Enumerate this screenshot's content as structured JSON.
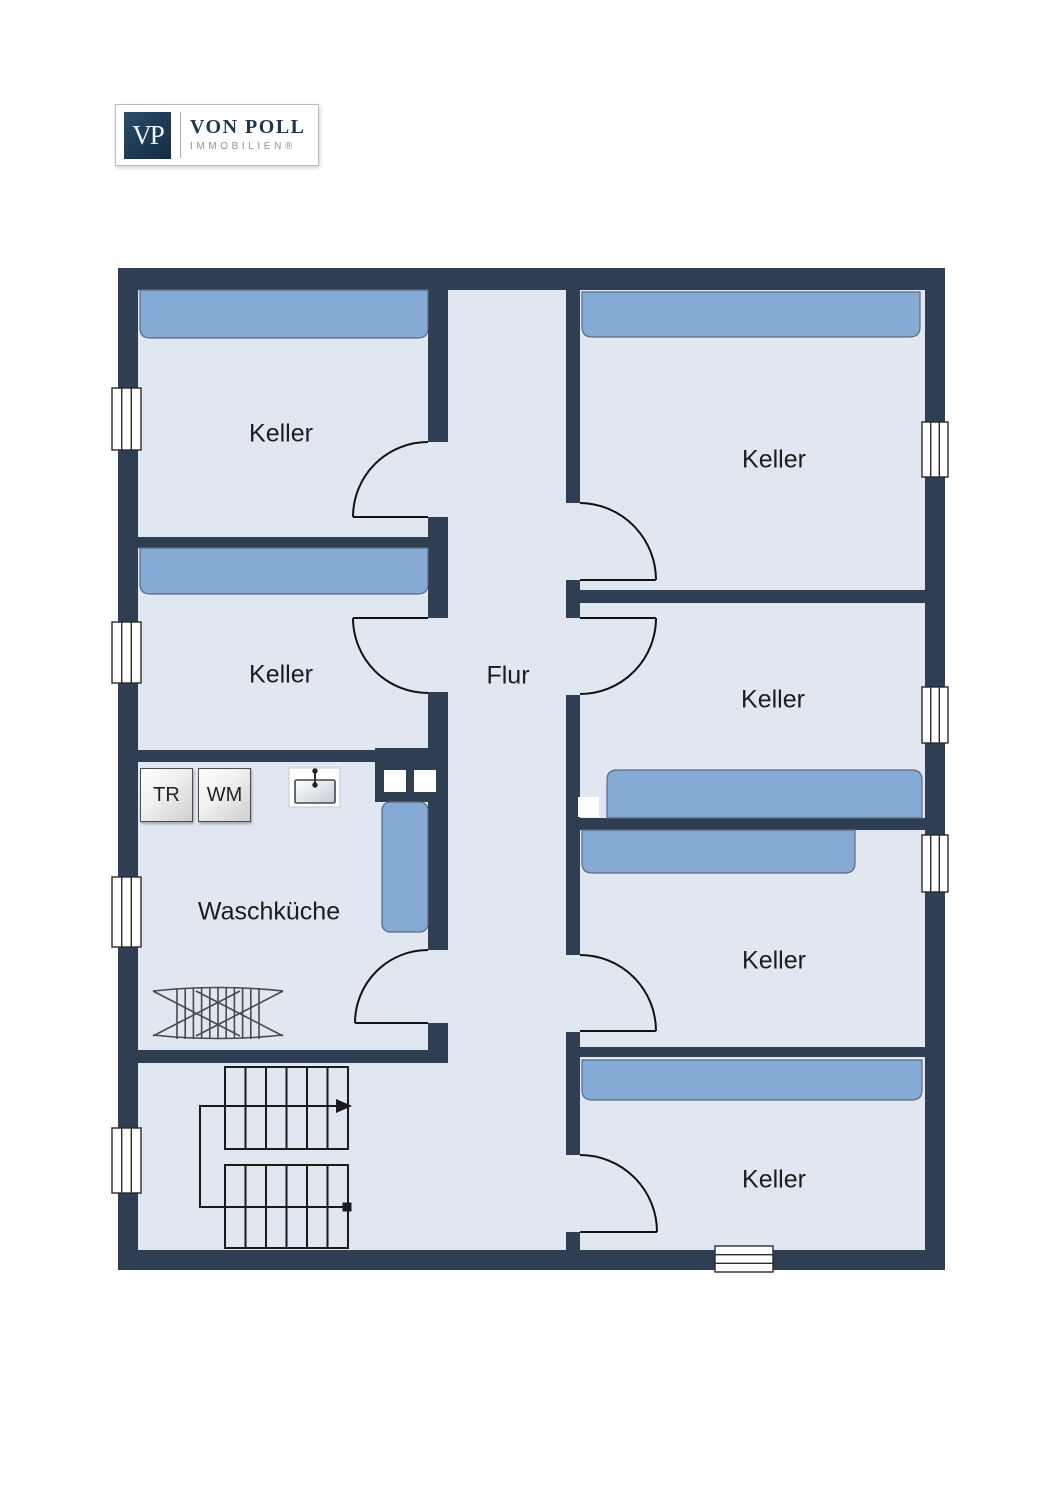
{
  "logo": {
    "monogram": "VP",
    "brand": "VON POLL",
    "division": "IMMOBILIEN®"
  },
  "plan": {
    "floor": "basement",
    "rooms": [
      {
        "id": "keller-top-left",
        "label": "Keller"
      },
      {
        "id": "keller-mid-left",
        "label": "Keller"
      },
      {
        "id": "waschkueche",
        "label": "Waschküche"
      },
      {
        "id": "flur",
        "label": "Flur"
      },
      {
        "id": "keller-top-right",
        "label": "Keller"
      },
      {
        "id": "keller-mid-right",
        "label": "Keller"
      },
      {
        "id": "keller-lower-right",
        "label": "Keller"
      },
      {
        "id": "keller-bottom-right",
        "label": "Keller"
      }
    ],
    "appliances": [
      {
        "id": "dryer",
        "label": "TR"
      },
      {
        "id": "washing-machine",
        "label": "WM"
      }
    ],
    "fixtures": [
      "sink",
      "drying-rack",
      "staircase-up",
      "chimney-flues",
      "shelves",
      "windows",
      "doors"
    ],
    "colors": {
      "wall": "#2f3e52",
      "floor": "#e1e7f0",
      "shelf": "#86aad6",
      "shelf_border": "#5a6a80"
    }
  }
}
